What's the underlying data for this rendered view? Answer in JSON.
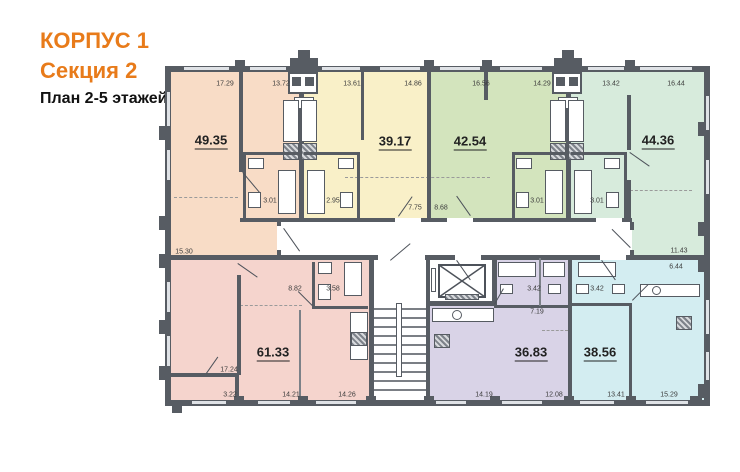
{
  "title": {
    "building": "КОРПУС 1",
    "section": "Секция 2",
    "plan": "План 2-5 этажей"
  },
  "colors": {
    "title_accent": "#e87b1a",
    "wall": "#575c63",
    "apartment_peach": "#f8dcc6",
    "apartment_yellow": "#f9f0c8",
    "apartment_olive": "#d3e4bd",
    "apartment_mint": "#d7ebdc",
    "apartment_pink": "#f5d4cd",
    "apartment_purple": "#d9d3e7",
    "apartment_blue": "#d3edf1"
  },
  "apartments": [
    {
      "area": "49.35",
      "color": "#f8dcc6"
    },
    {
      "area": "39.17",
      "color": "#f9f0c8"
    },
    {
      "area": "42.54",
      "color": "#d3e4bd"
    },
    {
      "area": "44.36",
      "color": "#d7ebdc"
    },
    {
      "area": "61.33",
      "color": "#f5d4cd"
    },
    {
      "area": "36.83",
      "color": "#d9d3e7"
    },
    {
      "area": "38.56",
      "color": "#d3edf1"
    }
  ],
  "dims": [
    "17.29",
    "13.72",
    "13.61",
    "14.86",
    "16.56",
    "14.29",
    "13.42",
    "16.44",
    "3.01",
    "2.95",
    "7.75",
    "8.68",
    "3.01",
    "3.01",
    "15.30",
    "11.43",
    "6.44",
    "8.82",
    "3.58",
    "17.24",
    "3.22",
    "14.21",
    "14.26",
    "3.42",
    "3.42",
    "7.19",
    "14.19",
    "12.08",
    "13.41",
    "15.29"
  ]
}
